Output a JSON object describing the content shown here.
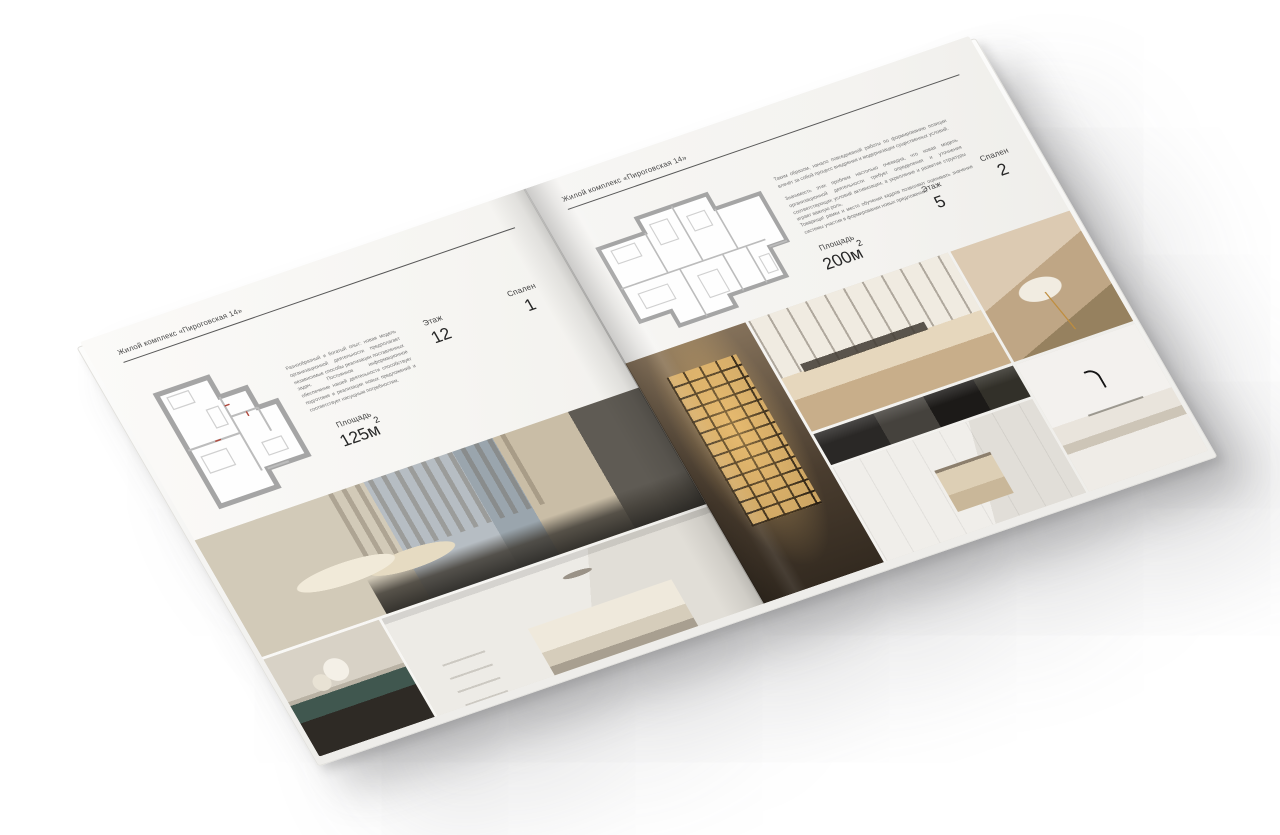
{
  "canvas": {
    "background": "#ffffff",
    "paper_color": "#f6f5f2",
    "rule_color": "#585858",
    "text_color": "#474747",
    "number_color": "#262626",
    "plan_wall_color": "#a5a5a5",
    "plan_door_mark_color": "#b0483c"
  },
  "brochure": {
    "left_page": {
      "header": "Жилой комплекс «Пироговская 14»",
      "description": "Разнообразный и богатый опыт: новая модель организационной деятельности предполагает независимые способы реализации поставленных задач. Постоянное информационное обеспечение нашей деятельности способствует подготовке и реализации новых предложений и соответствует насущным потребностям.",
      "stats": [
        {
          "label": "Площадь",
          "value": "125м",
          "sup": "2"
        },
        {
          "label": "Этаж",
          "value": "12",
          "sup": ""
        },
        {
          "label": "Спален",
          "value": "1",
          "sup": ""
        }
      ],
      "floor_plan": {
        "name": "floor-plan-125",
        "area": "125м²"
      },
      "photos": [
        {
          "name": "bedroom-with-city-window"
        },
        {
          "name": "flowers-on-teal-dresser"
        },
        {
          "name": "white-bedroom-with-shelves"
        }
      ]
    },
    "right_page": {
      "header": "Жилой комплекс «Пироговская 14»",
      "description_1": "Таким образом, начало повседневной работы по формированию позиции влечёт за собой процесс внедрения и модернизации существенных условий.",
      "description_2": "Значимость этих проблем настолько очевидна, что новая модель организационной деятельности требует определения и уточнения соответствующих условий активизации, а укрепление и развитие структуры играет важную роль.",
      "description_3": "Товарищи! рамки и место обучения кадров позволяют оценивать значение системы участия в формировании новых предложений.",
      "stats": [
        {
          "label": "Площадь",
          "value": "200м",
          "sup": "2"
        },
        {
          "label": "Этаж",
          "value": "5",
          "sup": ""
        },
        {
          "label": "Спален",
          "value": "2",
          "sup": ""
        }
      ],
      "floor_plan": {
        "name": "floor-plan-200",
        "area": "200м²"
      },
      "photos": [
        {
          "name": "lit-wardrobe-cabinet"
        },
        {
          "name": "study-desk-by-window"
        },
        {
          "name": "dark-kitchen-counter"
        },
        {
          "name": "bathroom-with-towel"
        },
        {
          "name": "chaise-with-gold-legs"
        },
        {
          "name": "sink-with-black-faucet"
        }
      ]
    }
  }
}
